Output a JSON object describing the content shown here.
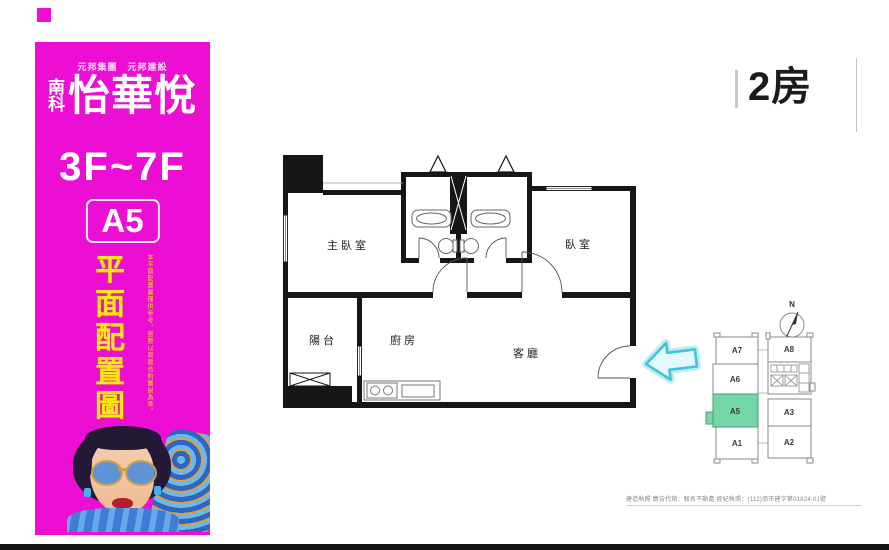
{
  "colors": {
    "accent_magenta": "#EC0FD3",
    "title_yellow": "#FFE713",
    "highlight_mint": "#74D7A7",
    "arrow_cyan": "#44C4D8"
  },
  "sidebar": {
    "company_line": "元邦集團　元邦建設",
    "logo_prefix": [
      "南",
      "科"
    ],
    "logo_name": "怡華悅",
    "floors": "3F~7F",
    "unit": "A5",
    "title_chars": [
      "平",
      "面",
      "配",
      "置",
      "圖"
    ],
    "disclaimer_vertical": "本平面配置圖僅供參考，實際以買賣合約圖說為準。"
  },
  "header": {
    "unit_type": "2房"
  },
  "floorplan": {
    "rooms": [
      {
        "label": "主臥室"
      },
      {
        "label": "臥室"
      },
      {
        "label": "陽台"
      },
      {
        "label": "廚房"
      },
      {
        "label": "客廳"
      }
    ]
  },
  "keyplan": {
    "compass": "N",
    "highlighted_unit": "A5",
    "units": [
      "A7",
      "A6",
      "A5",
      "A1",
      "A8",
      "A3",
      "A2"
    ]
  },
  "footer": {
    "fine_print": "建造執照 廣告代銷：駿名不動產 經紀執照：(112)南市建字第01824-01號"
  }
}
